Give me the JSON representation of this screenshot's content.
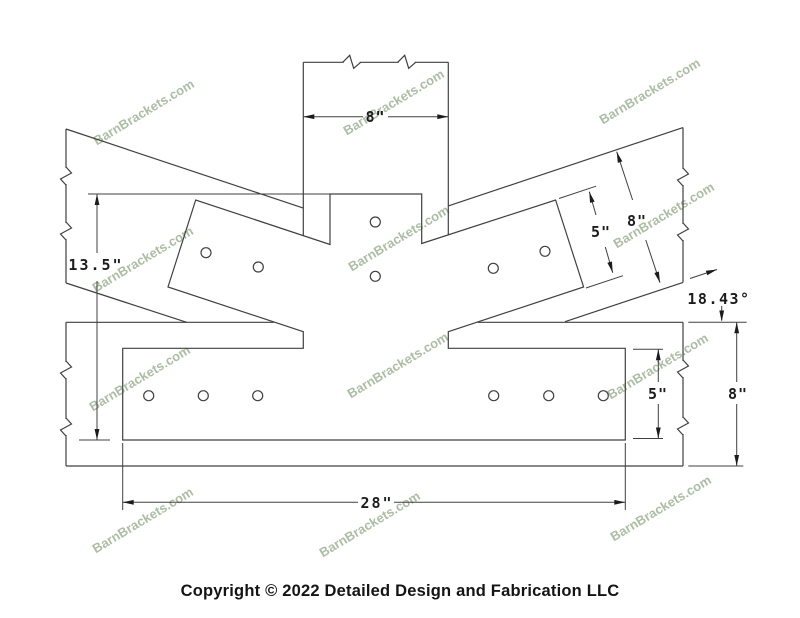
{
  "meta": {
    "width": 800,
    "height": 618,
    "background": "#ffffff",
    "line_color": "#404040"
  },
  "copyright": "Copyright © 2022 Detailed Design and Fabrication LLC",
  "watermark": {
    "text": "BarnBrackets.com",
    "color": "#8ba37f",
    "opacity": 0.72,
    "rotation": -31,
    "font_size": 13,
    "positions": [
      [
        146,
        116
      ],
      [
        396,
        106
      ],
      [
        652,
        95
      ],
      [
        145,
        263
      ],
      [
        401,
        242
      ],
      [
        666,
        219
      ],
      [
        142,
        382
      ],
      [
        400,
        369
      ],
      [
        660,
        370
      ],
      [
        145,
        524
      ],
      [
        372,
        528
      ],
      [
        663,
        512
      ]
    ]
  },
  "drawing": {
    "stroke": "#404040",
    "plate_outline": "330,194 421.7,194 421.7,243.5 555.6,200 583.6,287 448.3,331.7 448.3,348.3 625.3,348.3 625.3,440 122.7,440 122.7,348.3 303.3,348.3 303.3,331.7 168,287 195.7,200 330,244.5",
    "timber_lines": [
      [
        303.3,
        62.3,
        448.3,
        62.3
      ],
      [
        303.3,
        62.3,
        303.3,
        235.5
      ],
      [
        448.3,
        62.3,
        448.3,
        235.5
      ],
      [
        66,
        129,
        303.3,
        208.1
      ],
      [
        66,
        129,
        66,
        283
      ],
      [
        66,
        283,
        186.7,
        322.3
      ],
      [
        448.3,
        205.9,
        683,
        127.6
      ],
      [
        683,
        127.6,
        683,
        282.4
      ],
      [
        683,
        282.4,
        565,
        321.7
      ],
      [
        66,
        322.3,
        273.9,
        322.3
      ],
      [
        477.6,
        322.3,
        683,
        322.3
      ],
      [
        66,
        466,
        683,
        466
      ],
      [
        66,
        322.3,
        66,
        466
      ],
      [
        683,
        322.3,
        683,
        466
      ]
    ],
    "extension_lines": [
      [
        88,
        194,
        330,
        194
      ],
      [
        79,
        440,
        110,
        440
      ],
      [
        559,
        198.5,
        596,
        186.2
      ],
      [
        586,
        288,
        623,
        275.7
      ],
      [
        688.3,
        322.3,
        746.7,
        322.3
      ],
      [
        688.3,
        466,
        743.3,
        466
      ],
      [
        633,
        349.3,
        663,
        349.3
      ],
      [
        633,
        438.5,
        663,
        438.5
      ],
      [
        122.7,
        443,
        122.7,
        510
      ],
      [
        625.3,
        443,
        625.3,
        510
      ],
      [
        690,
        278.5,
        717,
        269.5
      ],
      [
        721.7,
        306,
        721.7,
        320.5
      ]
    ],
    "dimension_lines": [
      [
        97,
        194,
        97,
        253
      ],
      [
        97,
        281,
        97,
        440
      ],
      [
        303.3,
        116.7,
        363,
        116.7
      ],
      [
        388,
        116.7,
        448.3,
        116.7
      ],
      [
        589.3,
        191.7,
        596,
        215
      ],
      [
        605.3,
        247,
        612.7,
        272.7
      ],
      [
        616.7,
        151.7,
        632.6,
        200
      ],
      [
        645.8,
        240,
        660,
        282.7
      ],
      [
        736.7,
        322.3,
        736.7,
        382
      ],
      [
        736.7,
        404,
        736.7,
        466
      ],
      [
        658.3,
        349.3,
        658.3,
        382
      ],
      [
        658.3,
        404,
        658.3,
        438.5
      ],
      [
        122.7,
        502.3,
        358,
        502.3
      ],
      [
        394,
        502.3,
        625.3,
        502.3
      ]
    ],
    "arrows": [
      {
        "tip": [
          97,
          194
        ],
        "angle": -90
      },
      {
        "tip": [
          97,
          440
        ],
        "angle": 90
      },
      {
        "tip": [
          303.3,
          116.7
        ],
        "angle": 180
      },
      {
        "tip": [
          448.3,
          116.7
        ],
        "angle": 0
      },
      {
        "tip": [
          589.3,
          191.7
        ],
        "angle": -106
      },
      {
        "tip": [
          612.7,
          272.7
        ],
        "angle": 74
      },
      {
        "tip": [
          616.7,
          151.7
        ],
        "angle": -108
      },
      {
        "tip": [
          660,
          282.7
        ],
        "angle": 72
      },
      {
        "tip": [
          736.7,
          322.3
        ],
        "angle": -90
      },
      {
        "tip": [
          736.7,
          466
        ],
        "angle": 90
      },
      {
        "tip": [
          658.3,
          349.3
        ],
        "angle": -90
      },
      {
        "tip": [
          658.3,
          438.5
        ],
        "angle": 90
      },
      {
        "tip": [
          122.7,
          502.3
        ],
        "angle": 180
      },
      {
        "tip": [
          625.3,
          502.3
        ],
        "angle": 0
      },
      {
        "tip": [
          717,
          269.5
        ],
        "angle": -18.4
      },
      {
        "tip": [
          721.7,
          321.5
        ],
        "angle": 90
      }
    ],
    "break_symbols": [
      {
        "x": 351.7,
        "y": 62.3,
        "o": "h"
      },
      {
        "x": 406.7,
        "y": 62.3,
        "o": "h"
      },
      {
        "x": 66,
        "y": 176,
        "o": "v"
      },
      {
        "x": 66,
        "y": 231,
        "o": "v"
      },
      {
        "x": 683,
        "y": 177,
        "o": "v"
      },
      {
        "x": 683,
        "y": 232,
        "o": "v"
      },
      {
        "x": 66,
        "y": 370,
        "o": "v"
      },
      {
        "x": 66,
        "y": 427,
        "o": "v"
      },
      {
        "x": 683,
        "y": 369,
        "o": "v"
      },
      {
        "x": 683,
        "y": 426,
        "o": "v"
      }
    ],
    "holes": {
      "radius": 5,
      "centers": [
        [
          148.7,
          395.7
        ],
        [
          203.3,
          395.7
        ],
        [
          257.7,
          395.7
        ],
        [
          493.7,
          395.7
        ],
        [
          548.7,
          395.7
        ],
        [
          603.3,
          395.7
        ],
        [
          206,
          252.7
        ],
        [
          258.3,
          267
        ],
        [
          493.3,
          268.3
        ],
        [
          545,
          251.3
        ],
        [
          375.3,
          222
        ],
        [
          375.3,
          276.3
        ]
      ]
    },
    "labels": [
      {
        "text": "8\"",
        "x": 375.5,
        "y": 122,
        "ls": 1
      },
      {
        "text": "13.5\"",
        "x": 96,
        "y": 270,
        "ls": 2
      },
      {
        "text": "5\"",
        "x": 601,
        "y": 237,
        "ls": 1
      },
      {
        "text": "8\"",
        "x": 637,
        "y": 226,
        "ls": 1
      },
      {
        "text": "18.43°",
        "x": 719,
        "y": 304,
        "ls": 1.5
      },
      {
        "text": "8\"",
        "x": 738,
        "y": 399,
        "ls": 1
      },
      {
        "text": "5\"",
        "x": 658,
        "y": 399,
        "ls": 1
      },
      {
        "text": "28\"",
        "x": 377,
        "y": 508,
        "ls": 2
      }
    ]
  }
}
